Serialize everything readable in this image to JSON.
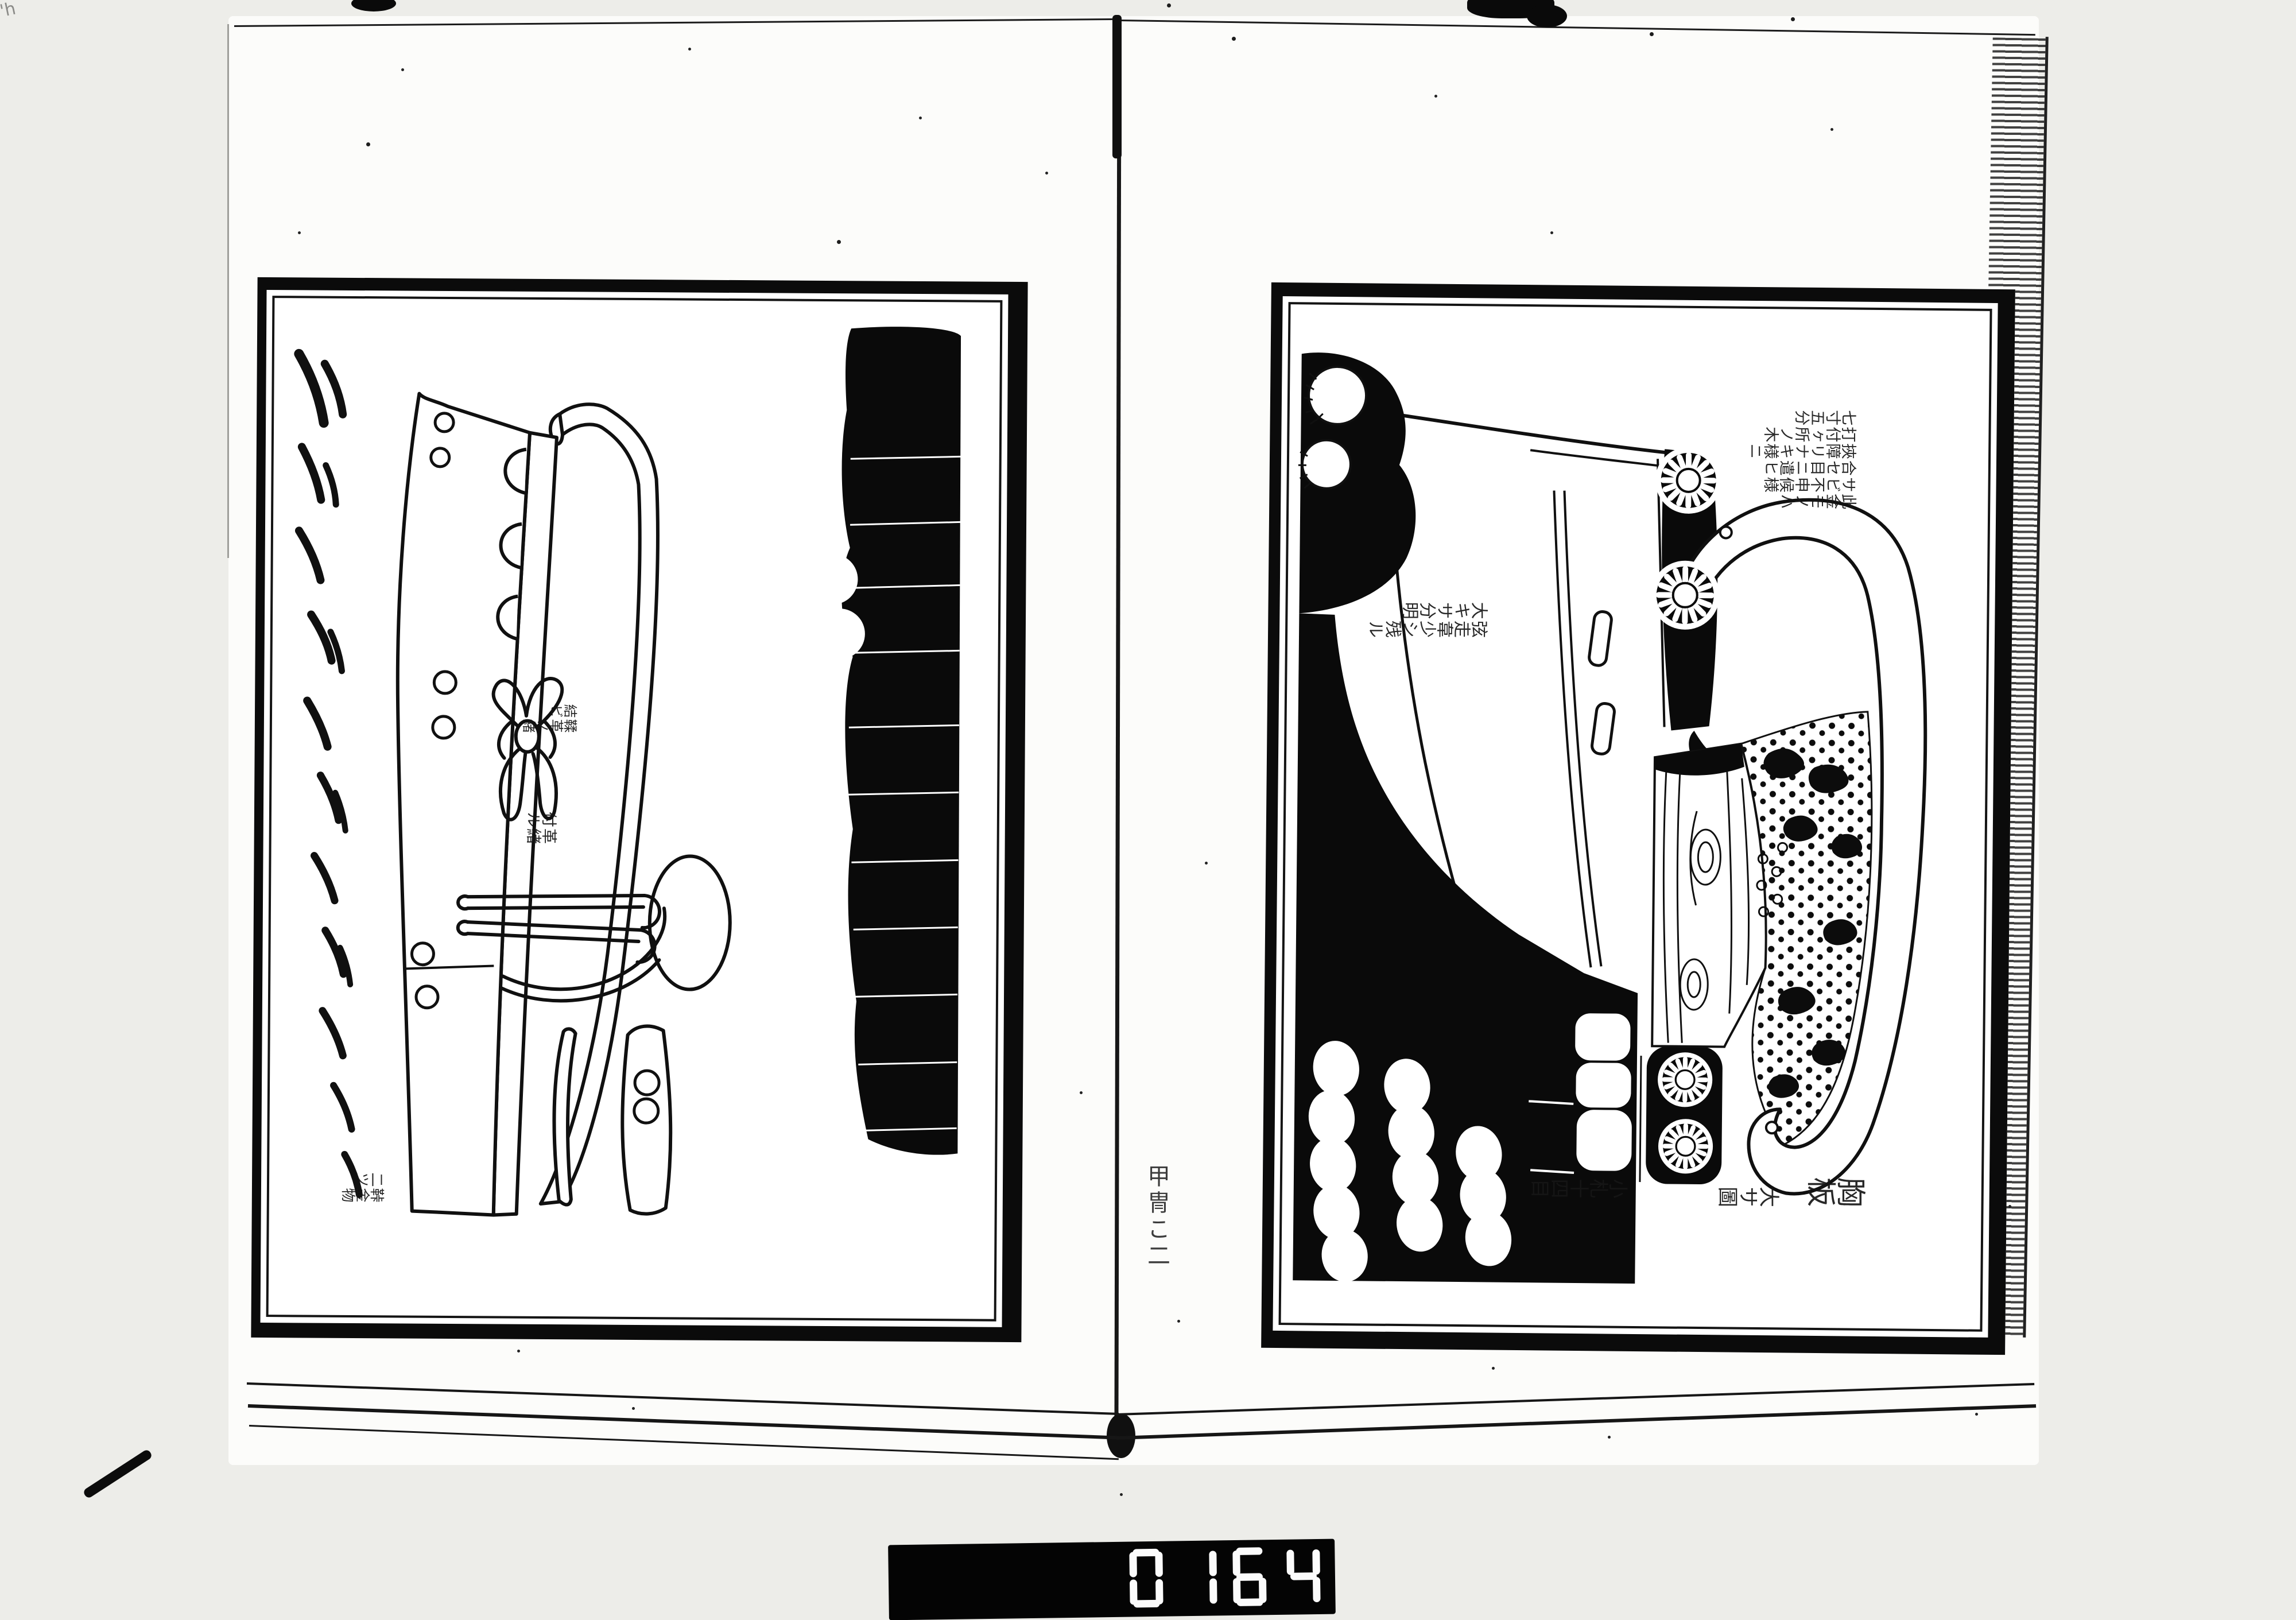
{
  "meta": {
    "colors": {
      "paper": "#fcfcfa",
      "ink": "#0b0b0b",
      "counter_bg": "#040404",
      "counter_digit": "#fbfbfb"
    }
  },
  "book": {
    "gutter_note": "甲冑こ二"
  },
  "left_page": {
    "subject": "armor-plate-with-cord-bow",
    "labels": {
      "bow_lines": [
        "鞣革ノ緒",
        "結ビ"
      ],
      "strap_lines": [
        "革緒",
        "付ル"
      ],
      "parts_lines": [
        "鞐金物",
        "二ツ"
      ]
    }
  },
  "right_page": {
    "subject": "chest-plate-diagram",
    "notes": {
      "top_lines": [
        "此金モノハ",
        "サビ不申候様",
        "合セ目ニ遣ヒ",
        "挾障リナキ様ニ",
        "打付ヶ所ノ木",
        "七寸五分"
      ],
      "side_lines": [
        "弦走韋少シ残ル",
        "大キサ分明"
      ],
      "scales_line": "小札十四目",
      "caption_title": "胸板",
      "caption_sub": "大サ圖"
    }
  },
  "film_counter": {
    "value": "0164"
  }
}
